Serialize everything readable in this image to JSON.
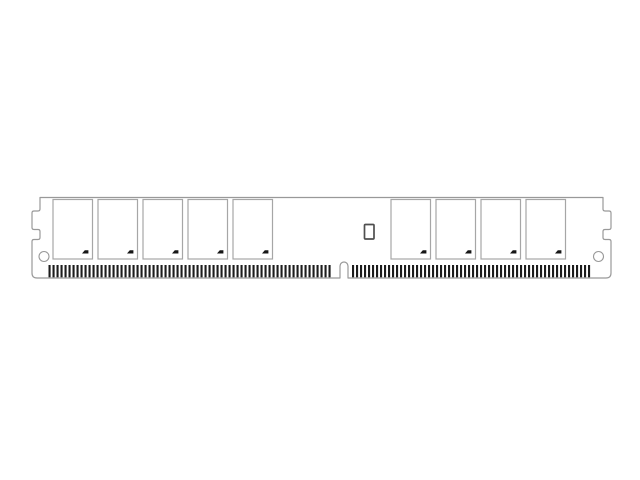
{
  "canvas": {
    "width": 640,
    "height": 480,
    "background": "#ffffff"
  },
  "illustration": {
    "subject": "DIMM memory module line drawing",
    "aria_label": "Line drawing of a low-profile DIMM memory module with nine memory chips, an SPD chip, side notches, round mounting holes, a keyed bottom edge and rows of edge-connector pins",
    "colors": {
      "background": "#ffffff",
      "outline": "#999999",
      "chip_outline": "#a6a6a6",
      "pin": "#1c1c1c",
      "fill": "#ffffff",
      "spd_outline": "#4f4f4f",
      "logo": "#161616"
    },
    "chips": {
      "left_count": 5,
      "right_count": 4,
      "total": 9,
      "logo": "manufacturer-swoosh"
    },
    "pins": {
      "left_section_count": 71,
      "right_section_count": 60
    },
    "features": [
      "left-side-notch",
      "right-side-notch",
      "left-mounting-hole",
      "right-mounting-hole",
      "bottom-key-notch",
      "spd-eeprom-chip"
    ]
  }
}
